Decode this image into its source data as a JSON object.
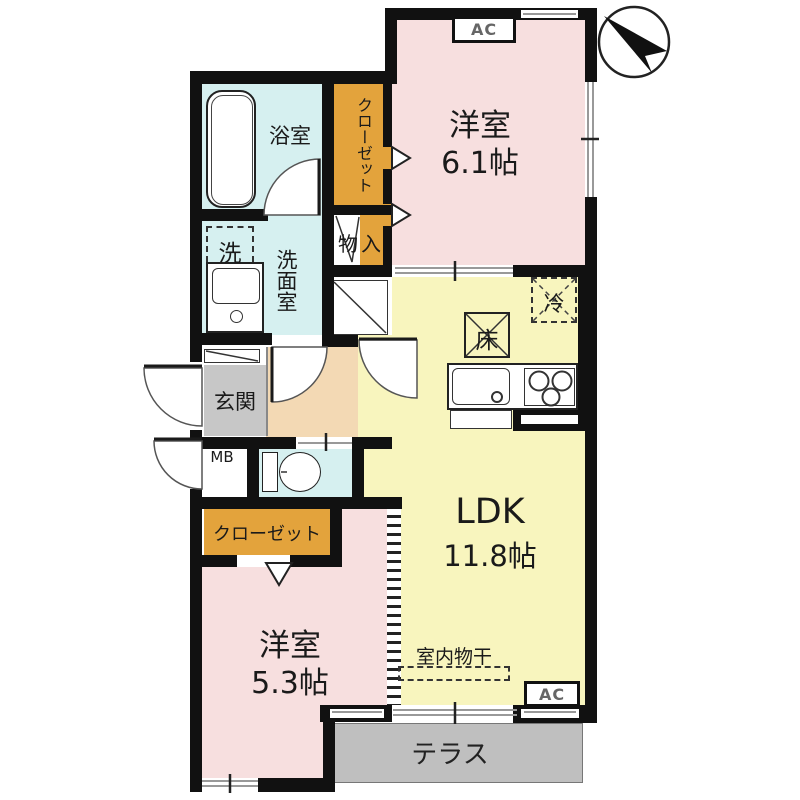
{
  "rooms": {
    "bedroom1": {
      "label": "洋室",
      "size": "6.1帖"
    },
    "bedroom2": {
      "label": "洋室",
      "size": "5.3帖"
    },
    "ldk": {
      "label": "LDK",
      "size": "11.8帖"
    },
    "bath": {
      "label": "浴室"
    },
    "washroom": {
      "label": "洗面室"
    },
    "closet_top": {
      "label": "クローゼット"
    },
    "closet_bottom": {
      "label": "クローゼット"
    },
    "storage": {
      "label": "物入"
    },
    "entrance": {
      "label": "玄関"
    },
    "terrace": {
      "label": "テラス"
    }
  },
  "fixtures": {
    "washer": "洗",
    "meter_box": "MB",
    "fridge": "冷",
    "floor_hatch": "床",
    "indoor_drying": "室内物干",
    "ac_top": "AC",
    "ac_bottom": "AC"
  },
  "icons": {
    "north_arrow": "compass-north-arrow"
  },
  "colors": {
    "wall": "#111111",
    "room_pink": "#F7DFDF",
    "room_yellow": "#F8F5BE",
    "room_cyan": "#D6F0F0",
    "closet_orange": "#E3A33C",
    "hall_beige": "#F3D9B4",
    "entrance_gray": "#C7C7C7",
    "terrace_gray": "#BFBFBF"
  }
}
